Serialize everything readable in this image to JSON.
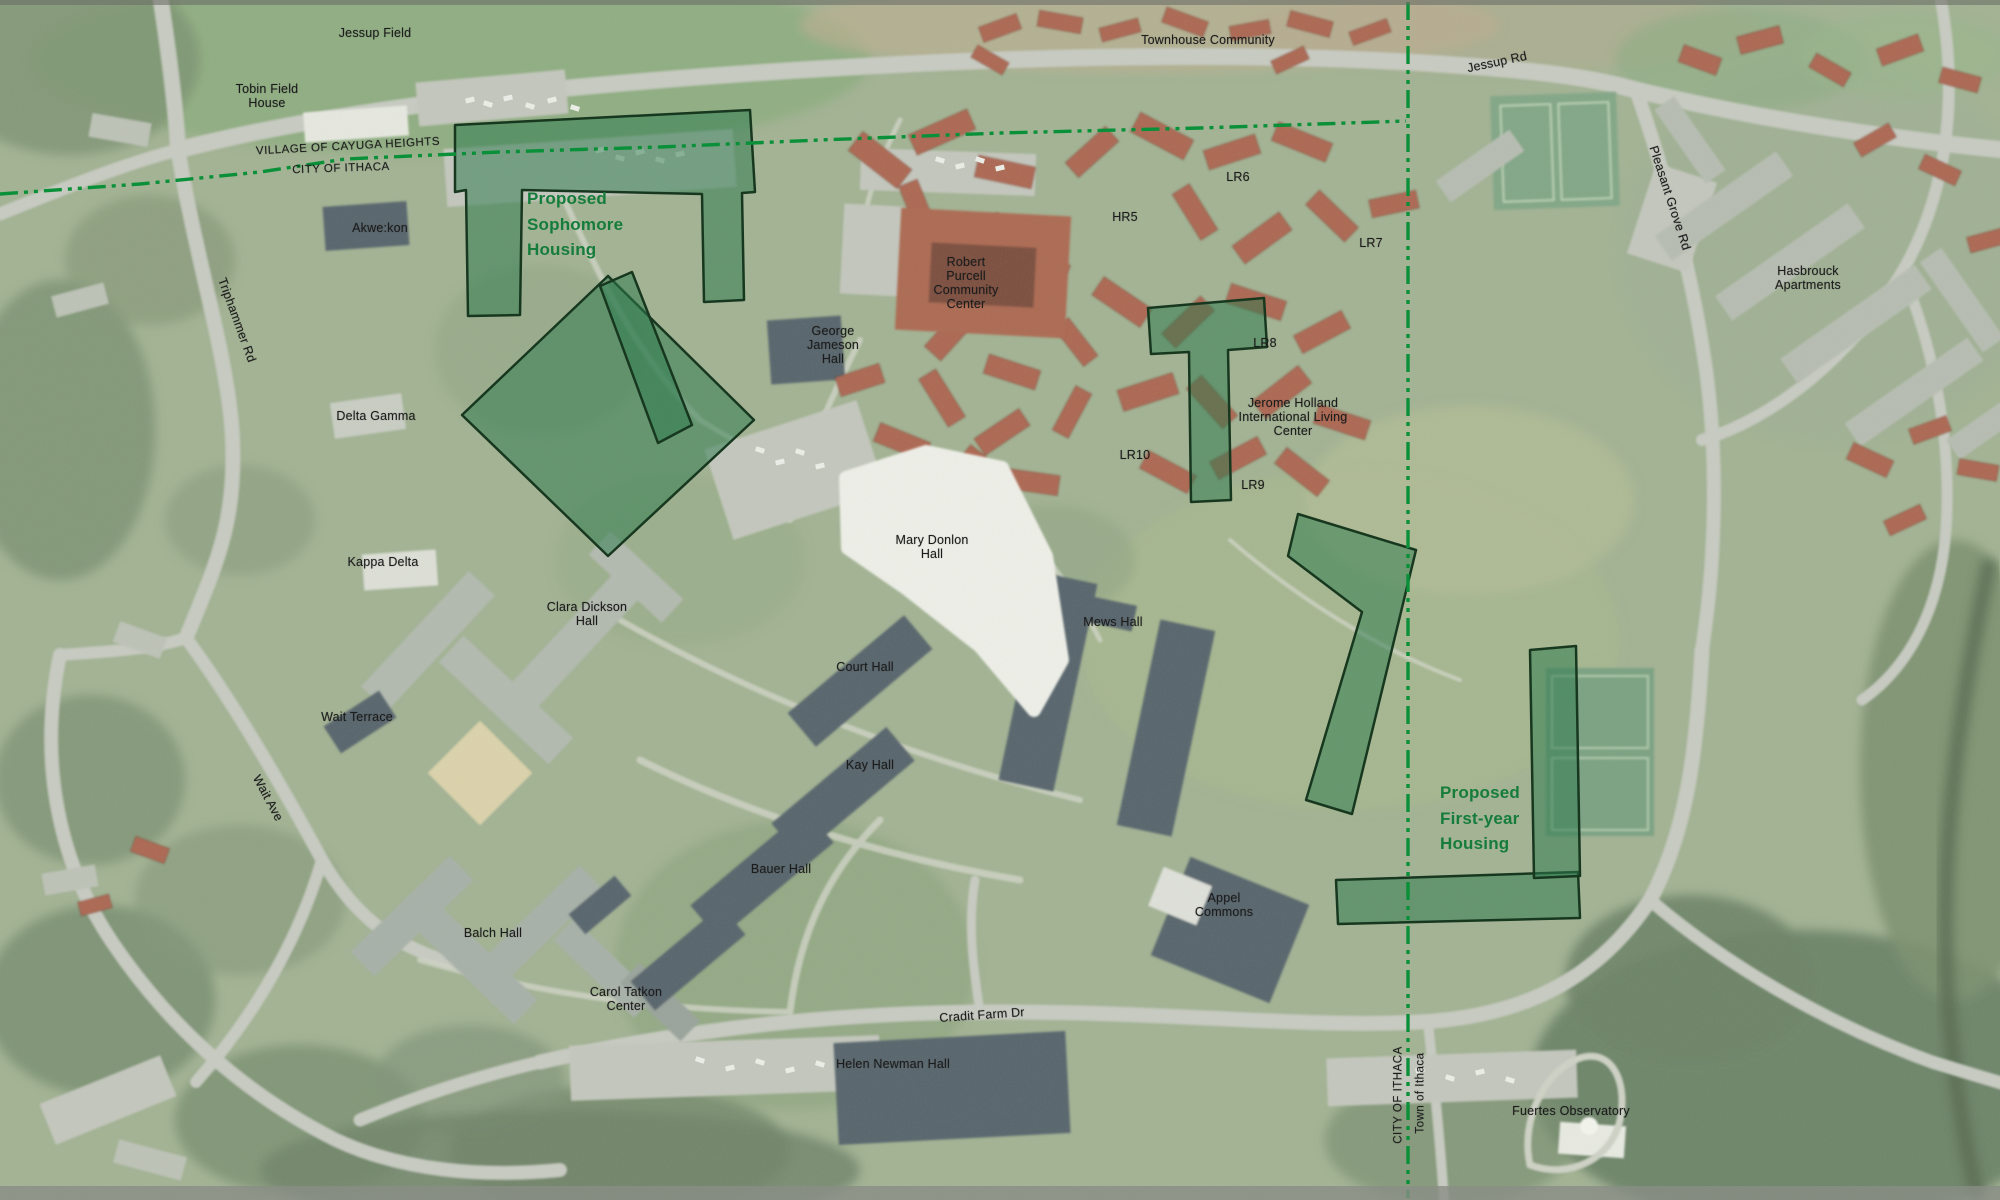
{
  "map": {
    "type": "aerial-campus-plan",
    "colors": {
      "proposed_site_fill": "#2e7a4f",
      "proposed_site_outline": "#17381f",
      "municipal_boundary_green": "#0a9038",
      "proposed_label_green": "#157c3b",
      "place_label_black": "#1c1c1c"
    },
    "proposed_sites": [
      {
        "name": "Proposed Sophomore Housing"
      },
      {
        "name": "Proposed First-year Housing"
      }
    ],
    "labels": [
      {
        "id": "jessup-field",
        "text": "Jessup Field",
        "x": 375,
        "y": 33,
        "rot": 0,
        "type": "place"
      },
      {
        "id": "tobin-field-house",
        "text": "Tobin Field\nHouse",
        "x": 267,
        "y": 96,
        "rot": 0,
        "type": "place"
      },
      {
        "id": "village-of-cayuga-heights",
        "text": "VILLAGE OF CAYUGA HEIGHTS",
        "x": 348,
        "y": 147,
        "rot": -3,
        "type": "boundary"
      },
      {
        "id": "city-of-ithaca-north",
        "text": "CITY OF ITHACA",
        "x": 341,
        "y": 169,
        "rot": -2,
        "type": "boundary"
      },
      {
        "id": "townhouse-community",
        "text": "Townhouse Community",
        "x": 1208,
        "y": 40,
        "rot": 0,
        "type": "place"
      },
      {
        "id": "jessup-rd",
        "text": "Jessup Rd",
        "x": 1497,
        "y": 62,
        "rot": -12,
        "type": "road"
      },
      {
        "id": "pleasant-grove-rd",
        "text": "Pleasant Grove Rd",
        "x": 1670,
        "y": 198,
        "rot": 72,
        "type": "road"
      },
      {
        "id": "akwekon",
        "text": "Akwe:kon",
        "x": 380,
        "y": 228,
        "rot": 0,
        "type": "place"
      },
      {
        "id": "triphammer-rd",
        "text": "Triphammer Rd",
        "x": 237,
        "y": 320,
        "rot": 70,
        "type": "road"
      },
      {
        "id": "delta-gamma",
        "text": "Delta Gamma",
        "x": 376,
        "y": 416,
        "rot": 0,
        "type": "place"
      },
      {
        "id": "kappa-delta",
        "text": "Kappa Delta",
        "x": 383,
        "y": 562,
        "rot": 0,
        "type": "place"
      },
      {
        "id": "wait-terrace",
        "text": "Wait Terrace",
        "x": 357,
        "y": 717,
        "rot": 0,
        "type": "place"
      },
      {
        "id": "wait-ave",
        "text": "Wait Ave",
        "x": 268,
        "y": 798,
        "rot": 62,
        "type": "road"
      },
      {
        "id": "proposed-sophomore-housing",
        "text": "Proposed\nSophomore\nHousing",
        "x": 527,
        "y": 186,
        "rot": 0,
        "type": "proposed"
      },
      {
        "id": "robert-purcell-community-center",
        "text": "Robert\nPurcell\nCommunity\nCenter",
        "x": 966,
        "y": 283,
        "rot": 0,
        "type": "place"
      },
      {
        "id": "george-jameson-hall",
        "text": "George\nJameson\nHall",
        "x": 833,
        "y": 345,
        "rot": 0,
        "type": "place"
      },
      {
        "id": "hr5",
        "text": "HR5",
        "x": 1125,
        "y": 217,
        "rot": 0,
        "type": "place"
      },
      {
        "id": "lr6",
        "text": "LR6",
        "x": 1238,
        "y": 177,
        "rot": 0,
        "type": "place"
      },
      {
        "id": "lr7",
        "text": "LR7",
        "x": 1371,
        "y": 243,
        "rot": 0,
        "type": "place"
      },
      {
        "id": "lr8",
        "text": "LR8",
        "x": 1265,
        "y": 343,
        "rot": 0,
        "type": "place"
      },
      {
        "id": "jerome-holland-ilc",
        "text": "Jerome Holland\nInternational Living\nCenter",
        "x": 1293,
        "y": 417,
        "rot": 0,
        "type": "place"
      },
      {
        "id": "lr10",
        "text": "LR10",
        "x": 1135,
        "y": 455,
        "rot": 0,
        "type": "place"
      },
      {
        "id": "lr9",
        "text": "LR9",
        "x": 1253,
        "y": 485,
        "rot": 0,
        "type": "place"
      },
      {
        "id": "hasbrouck-apartments",
        "text": "Hasbrouck\nApartments",
        "x": 1808,
        "y": 278,
        "rot": 0,
        "type": "place"
      },
      {
        "id": "mary-donlon-hall",
        "text": "Mary Donlon\nHall",
        "x": 932,
        "y": 547,
        "rot": 0,
        "type": "place"
      },
      {
        "id": "mews-hall",
        "text": "Mews Hall",
        "x": 1113,
        "y": 622,
        "rot": 0,
        "type": "place"
      },
      {
        "id": "court-hall",
        "text": "Court Hall",
        "x": 865,
        "y": 667,
        "rot": 0,
        "type": "place"
      },
      {
        "id": "kay-hall",
        "text": "Kay Hall",
        "x": 870,
        "y": 765,
        "rot": 0,
        "type": "place"
      },
      {
        "id": "bauer-hall",
        "text": "Bauer Hall",
        "x": 781,
        "y": 869,
        "rot": 0,
        "type": "place"
      },
      {
        "id": "clara-dickson-hall",
        "text": "Clara Dickson\nHall",
        "x": 587,
        "y": 614,
        "rot": 0,
        "type": "place"
      },
      {
        "id": "balch-hall",
        "text": "Balch Hall",
        "x": 493,
        "y": 933,
        "rot": 0,
        "type": "place"
      },
      {
        "id": "carol-tatkon-center",
        "text": "Carol Tatkon\nCenter",
        "x": 626,
        "y": 999,
        "rot": 0,
        "type": "place"
      },
      {
        "id": "helen-newman-hall",
        "text": "Helen Newman Hall",
        "x": 893,
        "y": 1064,
        "rot": 0,
        "type": "place"
      },
      {
        "id": "cradit-farm-dr",
        "text": "Cradit Farm Dr",
        "x": 982,
        "y": 1015,
        "rot": -4,
        "type": "road"
      },
      {
        "id": "appel-commons",
        "text": "Appel\nCommons",
        "x": 1224,
        "y": 905,
        "rot": 0,
        "type": "place"
      },
      {
        "id": "proposed-first-year-housing",
        "text": "Proposed\nFirst-year\nHousing",
        "x": 1440,
        "y": 780,
        "rot": 0,
        "type": "proposed"
      },
      {
        "id": "fuertes-observatory",
        "text": "Fuertes Observatory",
        "x": 1571,
        "y": 1111,
        "rot": 0,
        "type": "place"
      },
      {
        "id": "town-of-ithaca",
        "text": "Town of Ithaca",
        "x": 1421,
        "y": 1093,
        "rot": -90,
        "type": "boundary"
      },
      {
        "id": "city-of-ithaca-east",
        "text": "CITY OF ITHACA",
        "x": 1399,
        "y": 1095,
        "rot": -90,
        "type": "boundary"
      }
    ]
  }
}
